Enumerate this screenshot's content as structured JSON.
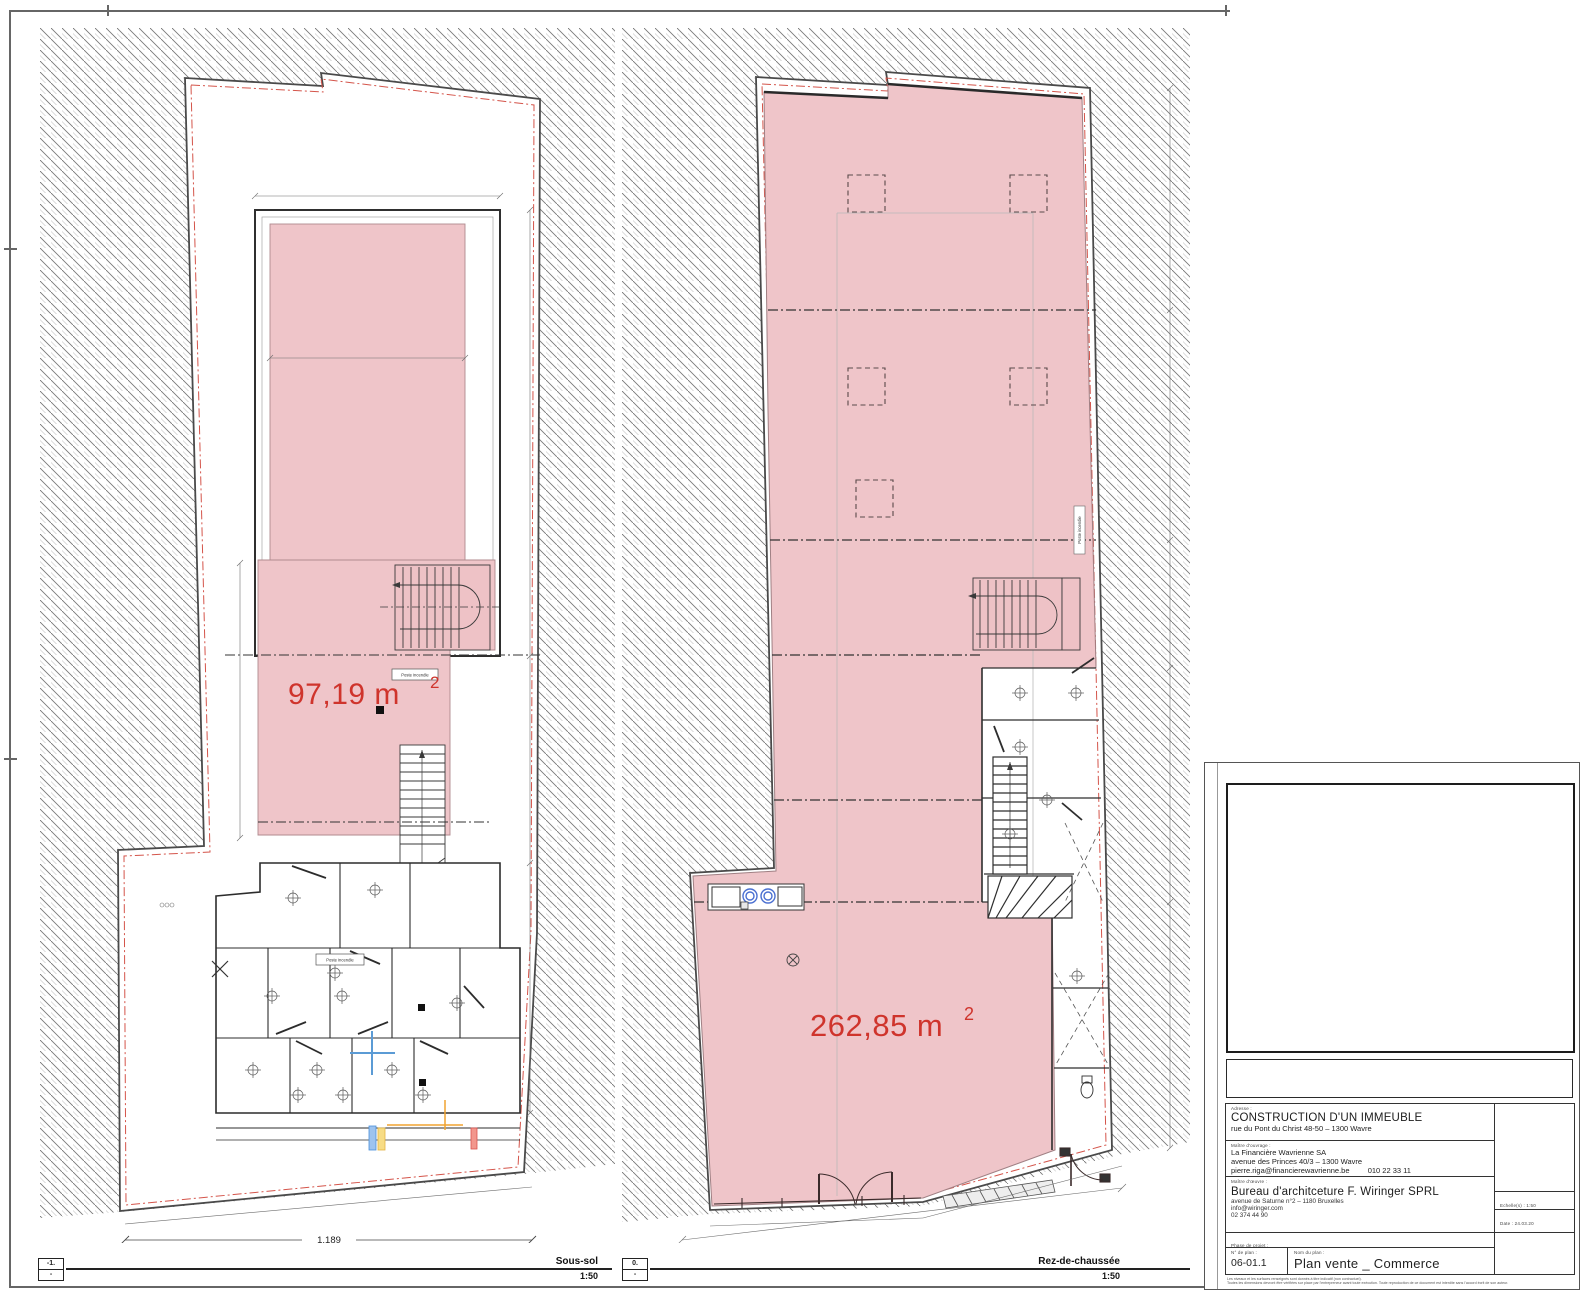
{
  "labels": {
    "poste_incendie": "Poste incendie"
  },
  "plans": [
    {
      "level_code": "-1.",
      "level_sub": "-",
      "name": "Sous-sol",
      "scale": "1:50",
      "area_value": "97,19 m",
      "area_exp": "2",
      "bottom_dimension": "1.189"
    },
    {
      "level_code": "0.",
      "level_sub": "-",
      "name": "Rez-de-chaussée",
      "scale": "1:50",
      "area_value": "262,85 m",
      "area_exp": "2"
    }
  ],
  "title_block": {
    "address_label": "Adresse :",
    "project_title": "CONSTRUCTION D'UN IMMEUBLE",
    "project_address": "rue du Pont du Christ 48-50 – 1300 Wavre",
    "client_label": "Maître d'ouvrage :",
    "client_name": "La Financière Wavrienne SA",
    "client_address": "avenue des Princes 40/3 – 1300 Wavre",
    "client_email": "pierre.riga@financierewavrienne.be",
    "client_phone": "010 22 33 11",
    "architect_label": "Maître d'œuvre :",
    "architect_name": "Bureau d'architceture F. Wiringer SPRL",
    "architect_address": "avenue de Saturne n°2 – 1180 Bruxelles",
    "architect_email": "info@wiringer.com",
    "architect_phone": "02 374 44 90",
    "scale_label": "Echelle(s) : 1:50",
    "date_label": "Date : 24.03.20",
    "phase_label": "Phase de projet :",
    "phase_value": "Commerce",
    "plan_number_label": "N° de plan :",
    "plan_number": "06-01.1",
    "plan_name_label": "Nom du plan :",
    "plan_name": "Plan vente _ Commerce",
    "disclaimer_line1": "Les niveaux et les surfaces renseignés sont donnés à titre indicatif (non contractuel).",
    "disclaimer_line2": "Toutes les dimensions devront être vérifiées sur place par l'entrepreneur avant toute exécution. Toute reproduction de ce document est interdite sans l'accord écrit de son auteur."
  },
  "colors": {
    "pink_fill": "#efc5c9",
    "area_label_red": "#cf342c",
    "red_dashdot": "#d4544a",
    "hatch_gray": "#787878",
    "wall_dark": "#333333"
  }
}
